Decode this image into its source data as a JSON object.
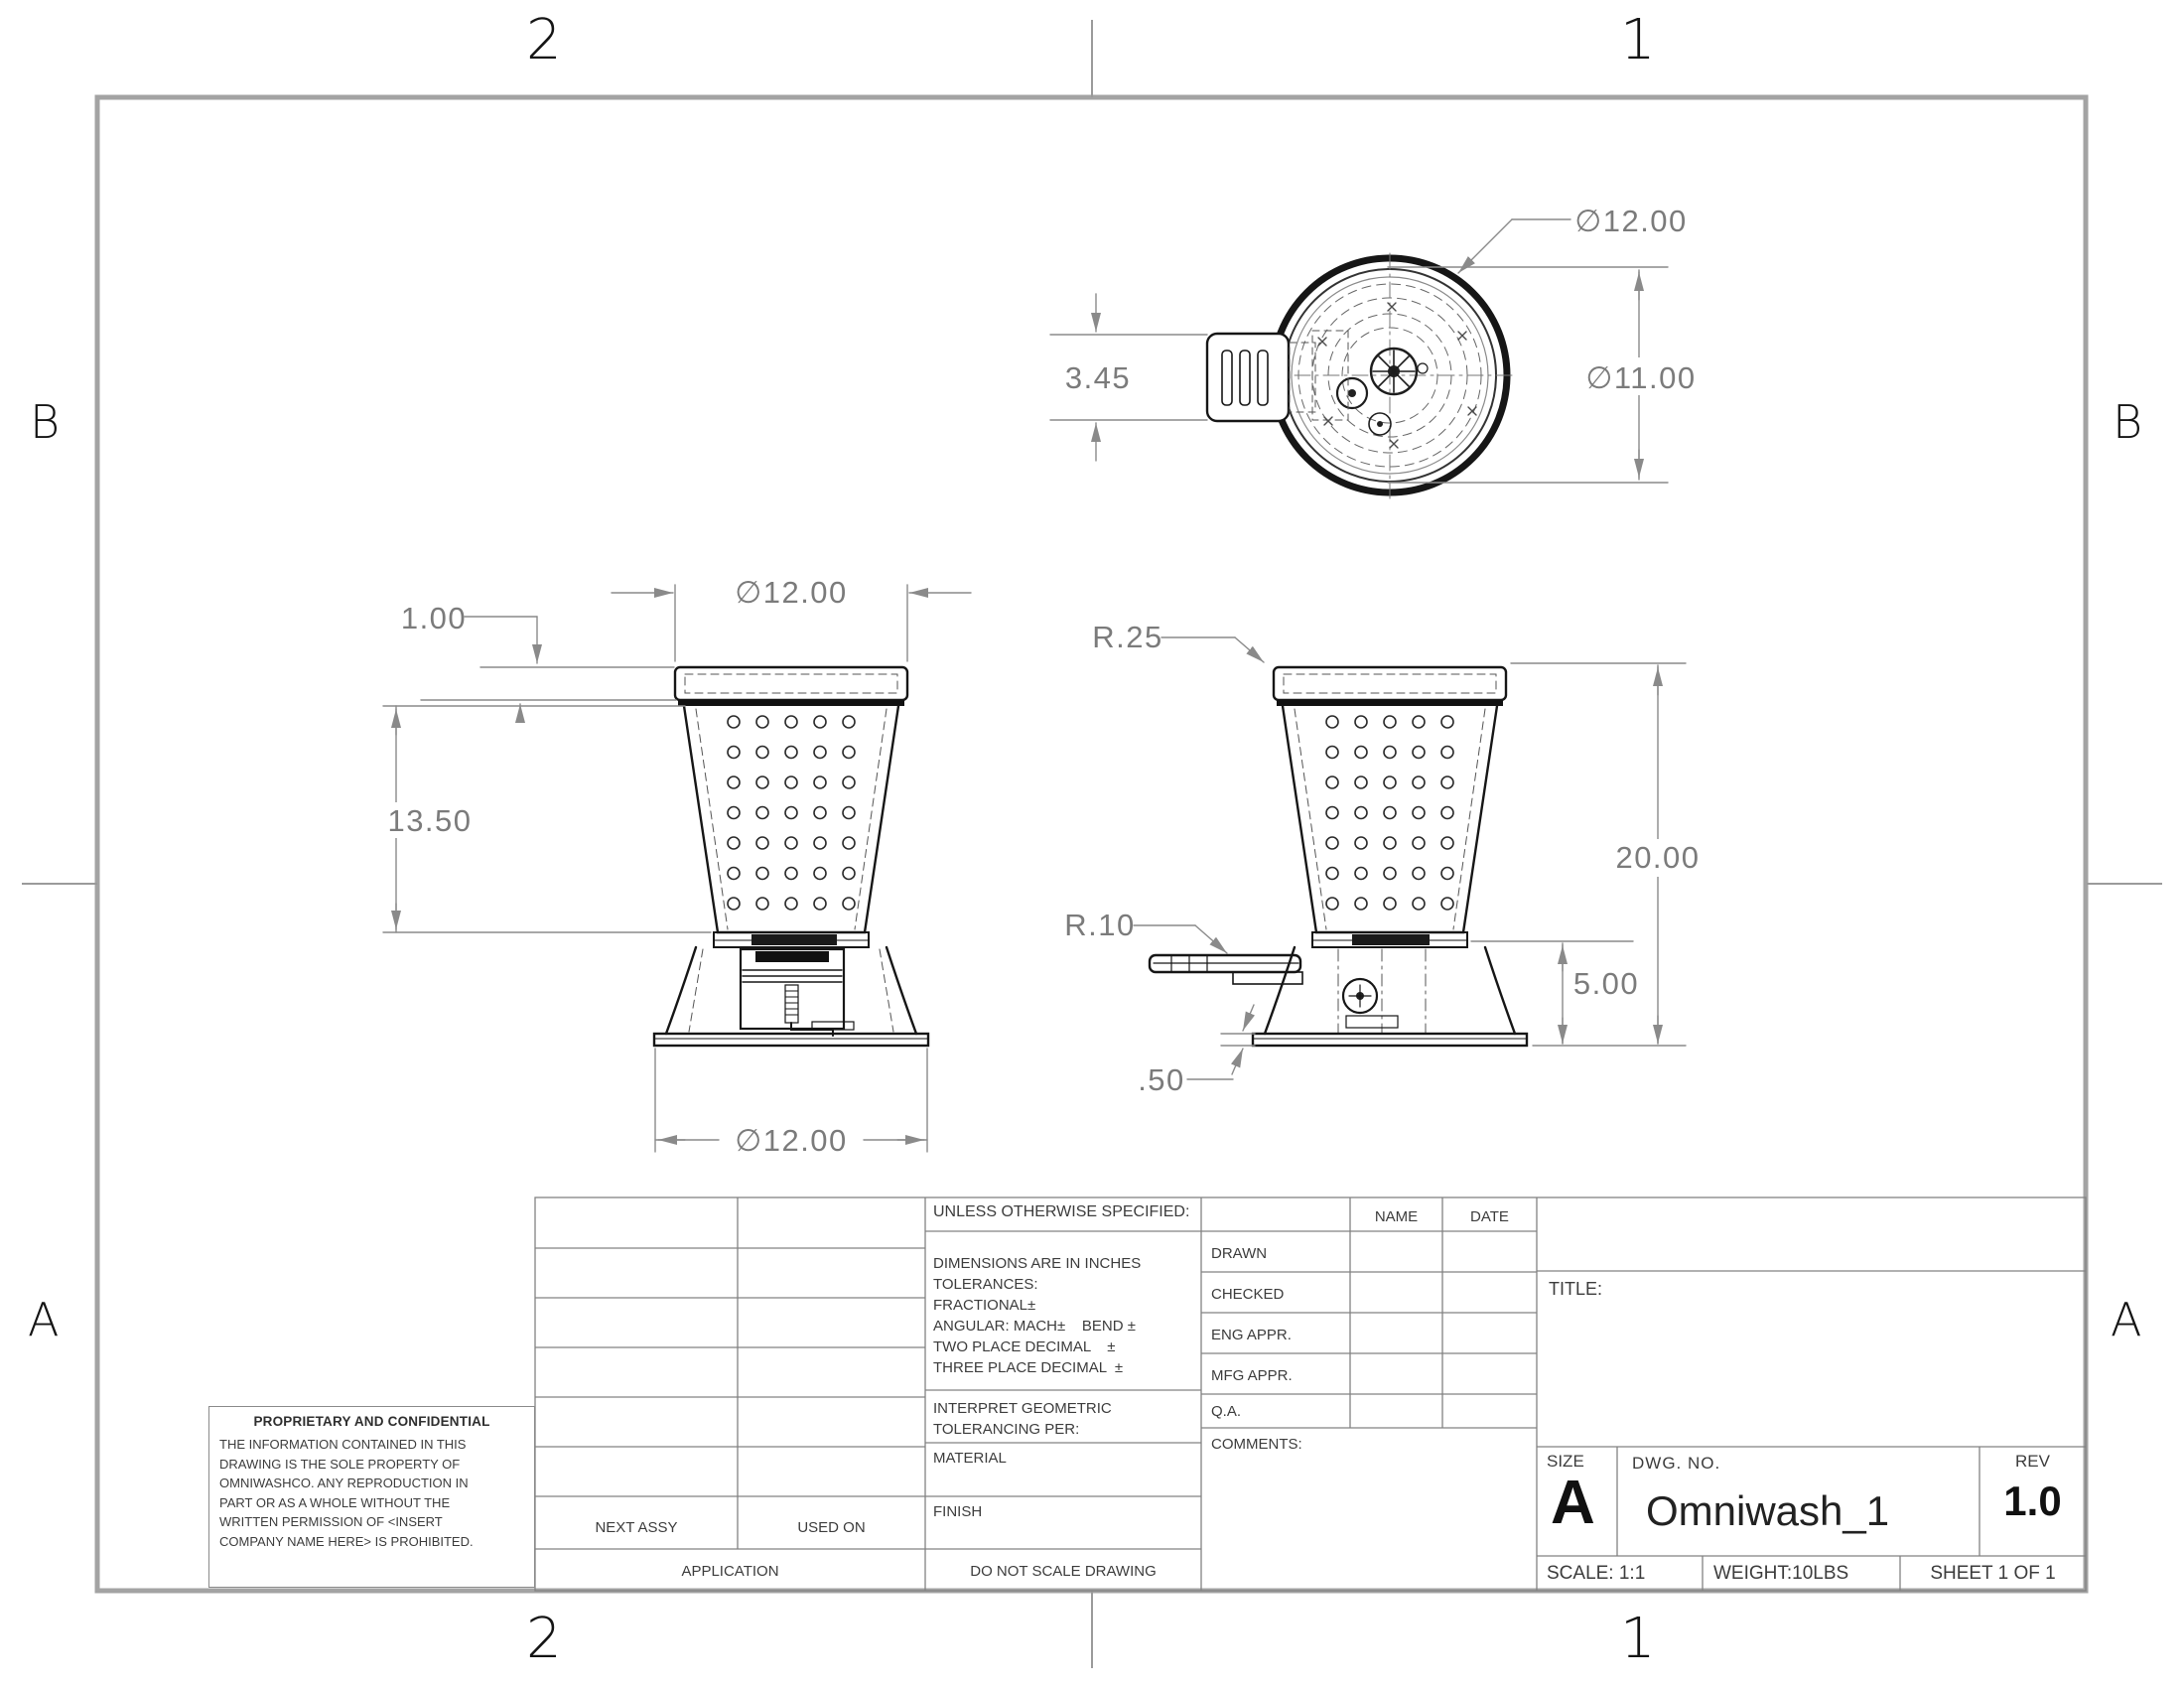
{
  "zones": {
    "top": [
      "2",
      "1"
    ],
    "bottom": [
      "2",
      "1"
    ],
    "left": [
      "B",
      "A"
    ],
    "right": [
      "B",
      "A"
    ]
  },
  "views": {
    "top_view": {
      "outer_dia": "∅12.00",
      "inner_dia": "∅11.00",
      "handle_width": "3.45"
    },
    "front_view": {
      "top_dia": "∅12.00",
      "lid_height": "1.00",
      "body_height": "13.50",
      "base_dia": "∅12.00"
    },
    "side_view": {
      "rim_radius": "R.25",
      "spout_radius": "R.10",
      "overall_height": "20.00",
      "base_height": "5.00",
      "plate_thickness": ".50"
    }
  },
  "title_block": {
    "unless": "UNLESS OTHERWISE SPECIFIED:",
    "spec_lines": [
      "DIMENSIONS ARE IN INCHES",
      "TOLERANCES:",
      "FRACTIONAL±",
      "ANGULAR: MACH±    BEND ±",
      "TWO PLACE DECIMAL    ±",
      "THREE PLACE DECIMAL  ±"
    ],
    "interpret_lines": [
      "INTERPRET GEOMETRIC",
      "TOLERANCING PER:"
    ],
    "material_label": "MATERIAL",
    "finish_label": "FINISH",
    "do_not_scale": "DO NOT SCALE DRAWING",
    "next_assy": "NEXT ASSY",
    "used_on": "USED ON",
    "application": "APPLICATION",
    "name_col": "NAME",
    "date_col": "DATE",
    "approval_rows": [
      "DRAWN",
      "CHECKED",
      "ENG APPR.",
      "MFG APPR.",
      "Q.A.",
      "COMMENTS:"
    ],
    "title_label": "TITLE:",
    "size_label": "SIZE",
    "size_value": "A",
    "dwg_label": "DWG.  NO.",
    "dwg_value": "Omniwash_1",
    "rev_label": "REV",
    "rev_value": "1.0",
    "scale": "SCALE: 1:1",
    "weight": "WEIGHT:10LBS",
    "sheet": "SHEET 1 OF 1",
    "proprietary": {
      "heading": "PROPRIETARY AND CONFIDENTIAL",
      "body_lines": [
        "THE INFORMATION CONTAINED IN THIS",
        "DRAWING IS THE SOLE PROPERTY OF",
        "OMNIWASHCO.  ANY REPRODUCTION IN",
        "PART OR AS A WHOLE WITHOUT THE",
        "WRITTEN PERMISSION OF <INSERT",
        "COMPANY NAME HERE> IS PROHIBITED."
      ]
    }
  }
}
